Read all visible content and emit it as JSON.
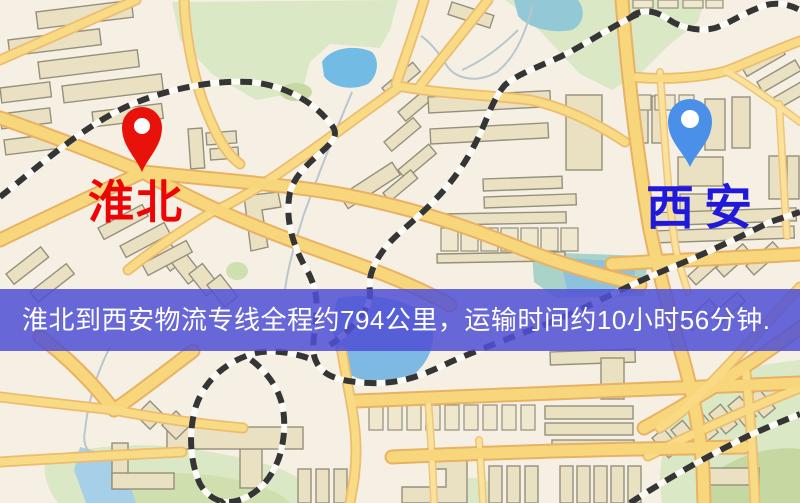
{
  "map": {
    "kind": "road-map",
    "markers": [
      {
        "id": "huaibei",
        "label": "淮北",
        "pin_color": "#e8120b",
        "label_color": "#ee0404"
      },
      {
        "id": "xian",
        "label": "西安",
        "pin_color": "#4a90e8",
        "label_color": "#2018dd"
      }
    ],
    "palette": {
      "background": "#f6f0e4",
      "road_fill": "#f8d77c",
      "road_casing": "#e9b164",
      "building": "#eae1c3",
      "building_stroke": "#95907c",
      "park": "#dbe8c6",
      "park_dark": "#c6d9a2",
      "water": "#7db9e2",
      "water_light": "#a6cfe8",
      "railway": "#353535"
    }
  },
  "banner": {
    "text": "淮北到西安物流专线全程约794公里，运输时间约10小时56分钟.",
    "bg_color": "#5050d6",
    "text_color": "#ffffff"
  },
  "route": {
    "origin": "淮北",
    "destination": "西安",
    "distance_text": "约794公里",
    "duration_text": "约10小时56分钟"
  }
}
